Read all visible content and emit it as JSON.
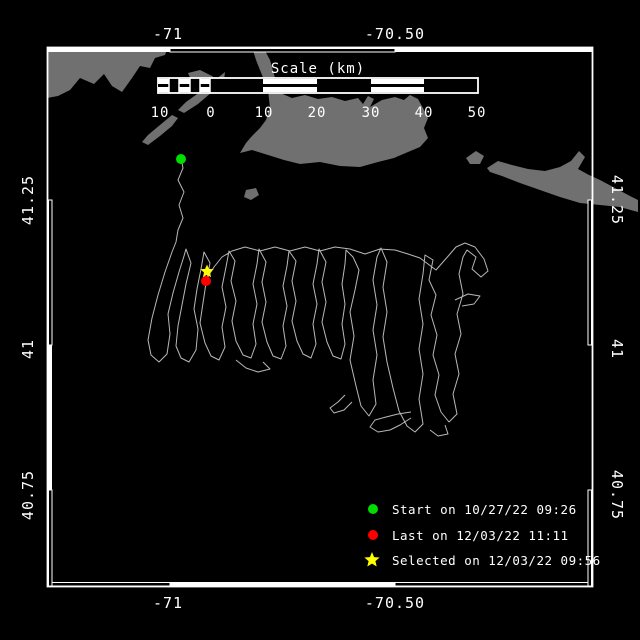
{
  "colors": {
    "background": "#000000",
    "frame": "#ffffff",
    "land": "#707070",
    "track": "#b8b8b8",
    "text": "#ffffff",
    "start": "#00dd00",
    "last": "#ff0000",
    "selected": "#ffff00"
  },
  "axes": {
    "top": [
      "-71",
      "-70.50"
    ],
    "bottom": [
      "-71",
      "-70.50"
    ],
    "left": [
      "41.25",
      "41",
      "40.75"
    ],
    "right": [
      "41.25",
      "41",
      "40.75"
    ]
  },
  "scale_bar": {
    "title": "Scale (km)",
    "ticks": [
      "10",
      "0",
      "10",
      "20",
      "30",
      "40",
      "50"
    ]
  },
  "legend": {
    "items": [
      {
        "marker": "circle",
        "color": "#00dd00",
        "label": "Start on 10/27/22 09:26"
      },
      {
        "marker": "circle",
        "color": "#ff0000",
        "label": "Last on 12/03/22 11:11"
      },
      {
        "marker": "star",
        "color": "#ffff00",
        "label": "Selected on 12/03/22 09:56"
      }
    ]
  },
  "map": {
    "land": [
      "47,47 168,47 165,55 155,58 150,68 140,66 132,78 122,92 112,86 104,74 94,84 80,78 70,90 58,96 47,98",
      "188,73 200,70 212,76 222,84 214,92 202,88 192,82",
      "225,72 215,80 200,92 186,102 178,110 184,113 198,104 212,92 224,80",
      "172,115 160,125 148,135 142,142 148,145 160,136 172,126 178,118",
      "252,47 263,47 270,60 275,78 278,92 292,98 305,95 318,99 332,97 345,101 358,98 363,104 368,96 374,99 370,107 382,100 395,97 404,100 410,95 418,99 423,108 428,118 424,128 428,138 420,147 408,152 394,158 378,162 360,167 340,166 320,162 300,164 284,160 268,155 252,150 240,153 246,143 252,136 260,128 266,120 270,108 268,90 262,75 256,60",
      "404,116 414,110 421,120 413,129",
      "487,168 498,161 512,165 528,169 545,171 560,167 571,161 579,151 585,157 578,169 589,175 600,180 615,188 630,196 638,200 638,212 620,207 600,205 580,203 560,197 540,190 520,183 502,176 490,172",
      "466,158 476,151 484,156 480,164 470,164",
      "246,190 256,188 259,195 251,200 244,197"
    ],
    "track_path": "M181,158 L183,168 178,180 184,192 179,205 183,218 178,230 176,242 172,252 165,272 158,295 152,318 148,340 151,355 159,362 167,354 170,334 168,314 173,293 179,272 184,256 186,249 191,263 186,284 182,305 178,326 176,346 181,358 189,362 196,350 198,329 194,309 197,289 201,269 204,252 210,263 206,283 203,303 200,323 205,343 211,356 219,360 225,347 222,327 226,307 222,287 226,267 229,251 235,261 231,281 236,301 232,321 236,341 243,355 251,358 256,344 253,324 257,304 253,284 257,264 259,249 266,262 262,282 266,302 262,322 267,342 273,356 281,359 286,346 283,326 287,306 283,286 287,266 289,251 296,261 292,281 296,301 292,321 297,341 303,354 311,358 316,344 313,324 317,304 313,284 317,264 319,249 326,262 322,282 326,302 322,322 327,342 333,356 341,359 345,344 342,324 345,304 342,284 345,264 346,250 353,257 359,270 355,290 350,312 354,336 350,360 356,386 361,406 369,416 376,404 373,380 377,355 373,330 377,305 373,280 377,257 381,248 387,262 383,287 387,312 383,337 387,362 393,388 399,411 407,426 415,432 423,424 419,399 423,374 419,349 423,324 419,299 423,274 425,255 433,260 429,280 436,295 431,315 437,335 433,355 439,375 435,395 441,412 449,422 457,414 453,394 459,374 455,354 461,334 457,314 463,294 459,274 463,257 467,250 476,257 472,269 481,277 488,271 484,259 475,247 465,243 456,247 450,254 443,262 436,270 428,264 420,258 408,254 395,250 380,249 365,254 350,249 335,247 320,251 305,247 290,251 275,247 260,251 245,247 232,251 222,257 214,267 209,275 206,281 M411,418 400,425 390,430 378,432 370,427 375,420 386,417 398,414 411,412 M430,430 438,436 448,434 445,425 M345,395 338,402 330,408 334,413 344,410 352,402 M236,360 246,368 258,372 270,369 263,362 M455,300 468,294 480,296 474,304 462,306",
    "markers": {
      "start": {
        "x": "181",
        "y": "159",
        "r": "5",
        "color": "#00dd00"
      },
      "last": {
        "x": "206",
        "y": "281",
        "r": "5",
        "color": "#ff0000"
      },
      "selected": {
        "points": "207,264.5 208.9,268.9 213.7,269.3 210,272.5 211.1,277.2 207,274.7 202.9,277.2 204,272.5 200.3,269.3 205.1,268.9",
        "color": "#ffff00"
      }
    }
  },
  "legend_markers": {
    "star_points": "372,552 374.1,557.1 379.6,557.5 375.4,561.1 376.7,566.5 372,563.6 367.3,566.5 368.6,561.1 364.4,557.5 369.9,557.1"
  }
}
